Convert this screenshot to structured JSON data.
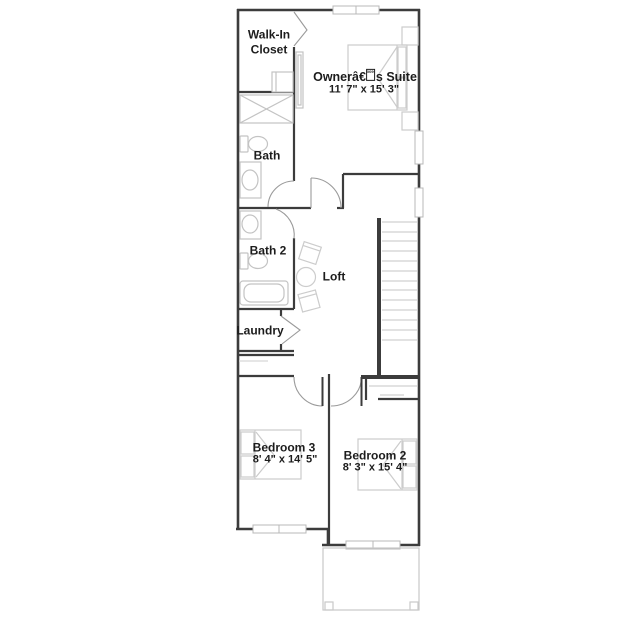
{
  "title": "Second floor plan",
  "floor_plan": {
    "rooms": [
      {
        "id": "walk_in_closet",
        "label": "Walk-In Closet",
        "label_lines": [
          "Walk-In",
          "Closet"
        ],
        "dimensions": ""
      },
      {
        "id": "owner_suite",
        "label_prefix": "Ownerâ€",
        "label_glyph": "0099",
        "label_suffix": "s Suite",
        "dimensions": "11' 7\" x 15' 3\""
      },
      {
        "id": "bath",
        "label": "Bath",
        "dimensions": ""
      },
      {
        "id": "bath_2",
        "label": "Bath 2",
        "dimensions": ""
      },
      {
        "id": "loft",
        "label": "Loft",
        "dimensions": ""
      },
      {
        "id": "laundry",
        "label": "Laundry",
        "dimensions": ""
      },
      {
        "id": "bedroom_3",
        "label": "Bedroom 3",
        "dimensions": "8' 4\" x 14' 5\""
      },
      {
        "id": "bedroom_2",
        "label": "Bedroom 2",
        "dimensions": "8' 3\" x 15' 4\""
      }
    ],
    "colors": {
      "wall": "#3c3c3c",
      "fixture": "#c3c3c3",
      "furniture": "#cccccc",
      "door_arc": "#9a9a9a",
      "stair_tread": "#d0d0d0",
      "text": "#1c1c1c",
      "background": "#ffffff"
    }
  }
}
